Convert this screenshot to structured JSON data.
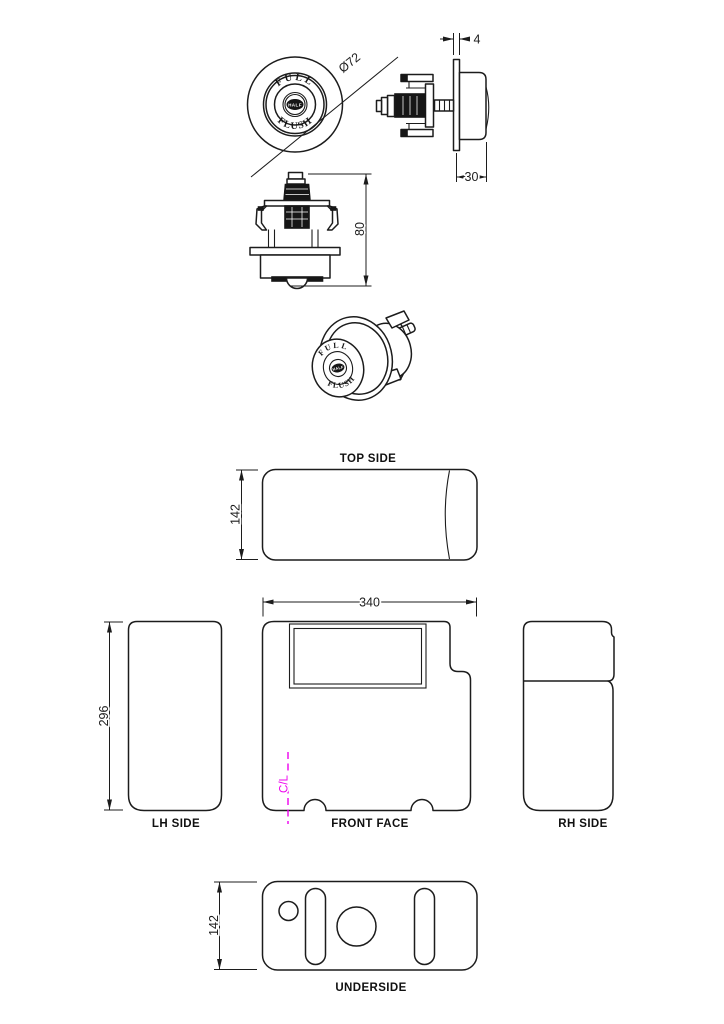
{
  "views": {
    "button_face": {
      "diameter": "Ø72",
      "text_top": "FULL",
      "text_center": "HALF",
      "text_bottom": "FLUSH"
    },
    "button_side": {
      "plate_thickness": "4",
      "button_depth": "30"
    },
    "mechanism_front": {
      "height": "80"
    },
    "button_3d": {
      "text_top": "FULL",
      "text_center": "HALF",
      "text_bottom": "FLUSH"
    },
    "top_side": {
      "label": "TOP SIDE",
      "depth": "142"
    },
    "front_face": {
      "label": "FRONT FACE",
      "width": "340",
      "centerline": "C/L"
    },
    "lh_side": {
      "label": "LH SIDE",
      "height": "296"
    },
    "rh_side": {
      "label": "RH SIDE"
    },
    "underside": {
      "label": "UNDERSIDE",
      "depth": "142"
    },
    "colors": {
      "line": "#1c1c1c",
      "centerline": "#ee00ee",
      "paper": "#ffffff"
    }
  }
}
